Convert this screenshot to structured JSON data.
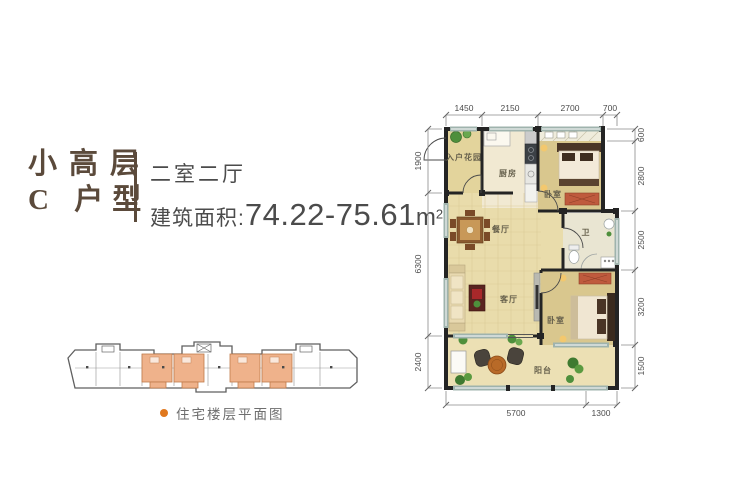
{
  "header": {
    "title_line1": "小高层",
    "title_line2": "C 户型",
    "subtitle": "二室二厅",
    "area_label": "建筑面积:",
    "area_value": "74.22-75.61",
    "area_unit": "m",
    "area_sup": "2",
    "title_color": "#5b4a3b",
    "text_color": "#4b4b4b"
  },
  "building_diagram": {
    "caption": "住宅楼层平面图",
    "highlight_color": "#efb28b",
    "accent_color": "#e0781e"
  },
  "plan": {
    "rooms": [
      {
        "id": "entry-garden",
        "label": "入户花园"
      },
      {
        "id": "kitchen",
        "label": "厨房"
      },
      {
        "id": "bedroom-1",
        "label": "卧室"
      },
      {
        "id": "dining",
        "label": "餐厅"
      },
      {
        "id": "bath",
        "label": "卫"
      },
      {
        "id": "living",
        "label": "客厅"
      },
      {
        "id": "bedroom-2",
        "label": "卧室"
      },
      {
        "id": "balcony",
        "label": "阳台"
      }
    ],
    "dims": {
      "top": [
        "1450",
        "2150",
        "2700",
        "700"
      ],
      "right": [
        "600",
        "2800",
        "2500",
        "3200",
        "1500"
      ],
      "left": [
        "1900",
        "6300",
        "2400"
      ],
      "bottom": [
        "5700",
        "1300"
      ]
    },
    "colors": {
      "wall": "#242424",
      "window": "#9fb3ad",
      "floor_main": "#e9dcab",
      "floor_bedroom": "#d9c78e",
      "floor_kitchen": "#f1e9d2",
      "floor_bath": "#e9e5d2",
      "floor_balcony": "#ece0b4"
    }
  }
}
